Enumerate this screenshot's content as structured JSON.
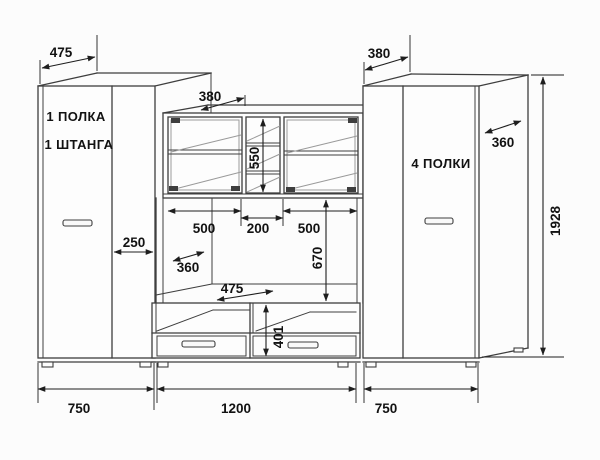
{
  "drawing_type": "furniture dimension drawing",
  "left_wardrobe": {
    "feature_1": "1 ПОЛКА",
    "feature_2": "1 ШТАНГА",
    "depth": "475",
    "right_section_width": "250",
    "width": "750"
  },
  "center_unit": {
    "top_depth": "380",
    "hutch_height": "550",
    "left_opening_width": "500",
    "middle_opening_width": "200",
    "right_opening_width": "500",
    "niche_height": "670",
    "niche_depth": "360",
    "base_depth": "475",
    "base_height": "401",
    "width": "1200"
  },
  "right_wardrobe": {
    "feature": "4 ПОЛКИ",
    "depth": "380",
    "side_depth": "360",
    "height": "1928",
    "width": "750"
  },
  "colors": {
    "background": "#fcfcfc",
    "line": "#3e3e3e",
    "dimension": "#1e1e1e",
    "detail": "#9a9a9a",
    "text": "#121212"
  }
}
